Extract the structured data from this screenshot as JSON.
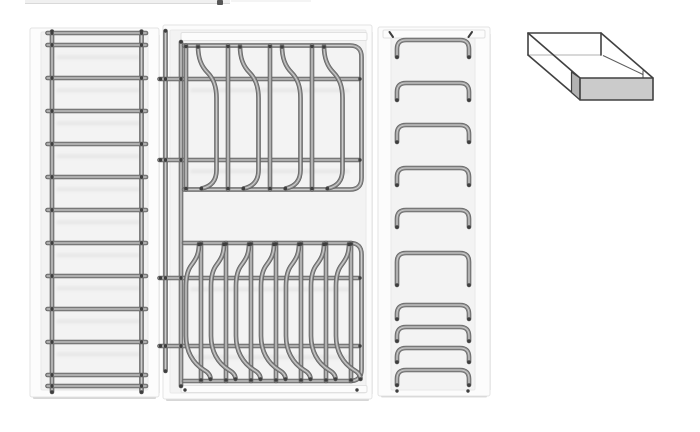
{
  "meta": {
    "description": "Product illustration of kitchen drawer organiser wire inserts: three white trays with chrome wire racks (ladder rack, two-tier plate rack, stacked bridge rack) and a 3D outline icon of a shallow open box"
  },
  "colors": {
    "page_bg": "#ffffff",
    "panel_frame": "#fcfcfc",
    "panel_face": "#f3f3f3",
    "panel_border": "#e3e3e3",
    "panel_shadow": "#c6c6c6",
    "wire_base": "#8f8f8f",
    "wire_dark": "#616161",
    "wire_highlight": "#cccccc",
    "wire_cap": "#3e3e3e",
    "icon_stroke": "#414141",
    "icon_face": "#cbcbcb",
    "icon_edge": "#b2b2b2",
    "icon_faint": "#cccccc",
    "topbar_fill": "#f0f0f0",
    "topbar_border": "#d9d9d9",
    "topbar_handle": "#565656"
  },
  "left_rack": {
    "bar_ys": [
      33,
      45,
      78,
      111,
      144,
      177,
      210,
      243,
      276,
      309,
      342,
      375,
      386
    ],
    "rail_xs": [
      52,
      141.5
    ]
  },
  "middle_rack": {
    "side_rail_xs": [
      165.5,
      181
    ],
    "top_tier": {
      "rail_top": 45.5,
      "rail_bottom": 189.5,
      "rail_mids": [
        79,
        160
      ],
      "vertical_xs": [
        186,
        228,
        270,
        312
      ],
      "curve_xs": [
        198,
        240,
        282,
        324
      ]
    },
    "bottom_tier": {
      "rail_top": 243,
      "rail_bottom": 381,
      "rail_mids": [
        278,
        346
      ],
      "vertical_xs": [
        201,
        226,
        251,
        276,
        301,
        326,
        351
      ],
      "curve_xs": [
        199,
        224,
        249,
        274,
        299,
        324,
        349
      ]
    }
  },
  "right_rack": {
    "bridges": [
      {
        "y": 40,
        "leg": 17
      },
      {
        "y": 83,
        "leg": 17
      },
      {
        "y": 125,
        "leg": 17
      },
      {
        "y": 168,
        "leg": 17
      },
      {
        "y": 210,
        "leg": 17
      },
      {
        "y": 253,
        "leg": 32
      },
      {
        "y": 305,
        "leg": 14
      },
      {
        "y": 327,
        "leg": 14
      },
      {
        "y": 348,
        "leg": 14
      },
      {
        "y": 370,
        "leg": 15
      }
    ]
  }
}
